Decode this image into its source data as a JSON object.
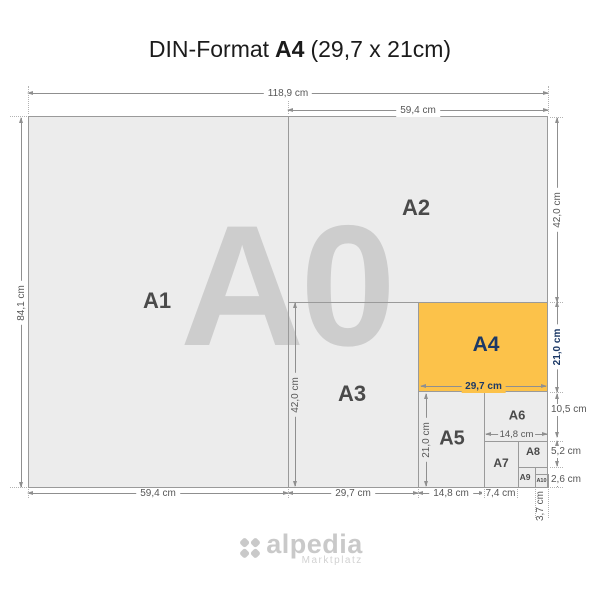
{
  "title": {
    "prefix": "DIN-Format",
    "format": "A4",
    "suffix": "(29,7 x 21cm)"
  },
  "watermark": "A0",
  "formats": {
    "a1": "A1",
    "a2": "A2",
    "a3": "A3",
    "a4": "A4",
    "a5": "A5",
    "a6": "A6",
    "a7": "A7",
    "a8": "A8",
    "a9": "A9",
    "a10": "A10"
  },
  "dims": {
    "a0_width": "118,9 cm",
    "a2_width": "59,4 cm",
    "a0_height": "84,1 cm",
    "a2_height": "42,0 cm",
    "a4_height": "21,0 cm",
    "a6_height": "10,5 cm",
    "a8_height": "5,2 cm",
    "a10_height": "2,6 cm",
    "a1_width": "59,4 cm",
    "a3_width": "29,7 cm",
    "a5_width": "14,8 cm",
    "a7_width": "7,4 cm",
    "a10_width": "3,7 cm",
    "a4_width": "29,7 cm",
    "a5_height": "21,0 cm",
    "a6_width": "14,8 cm",
    "a3_height": "42,0 cm"
  },
  "logo": {
    "name": "alpedia",
    "tagline": "Marktplatz"
  },
  "colors": {
    "paper": "#ececec",
    "line": "#9a9a9a",
    "dimline": "#8f8f8f",
    "dim": "#575757",
    "label": "#4a4a4a",
    "watermark": "#cdcdcd",
    "a4fill": "#fcc24a",
    "a4text": "#1c3966",
    "logo": "#c9c9c9",
    "title": "#1b1b1b"
  }
}
